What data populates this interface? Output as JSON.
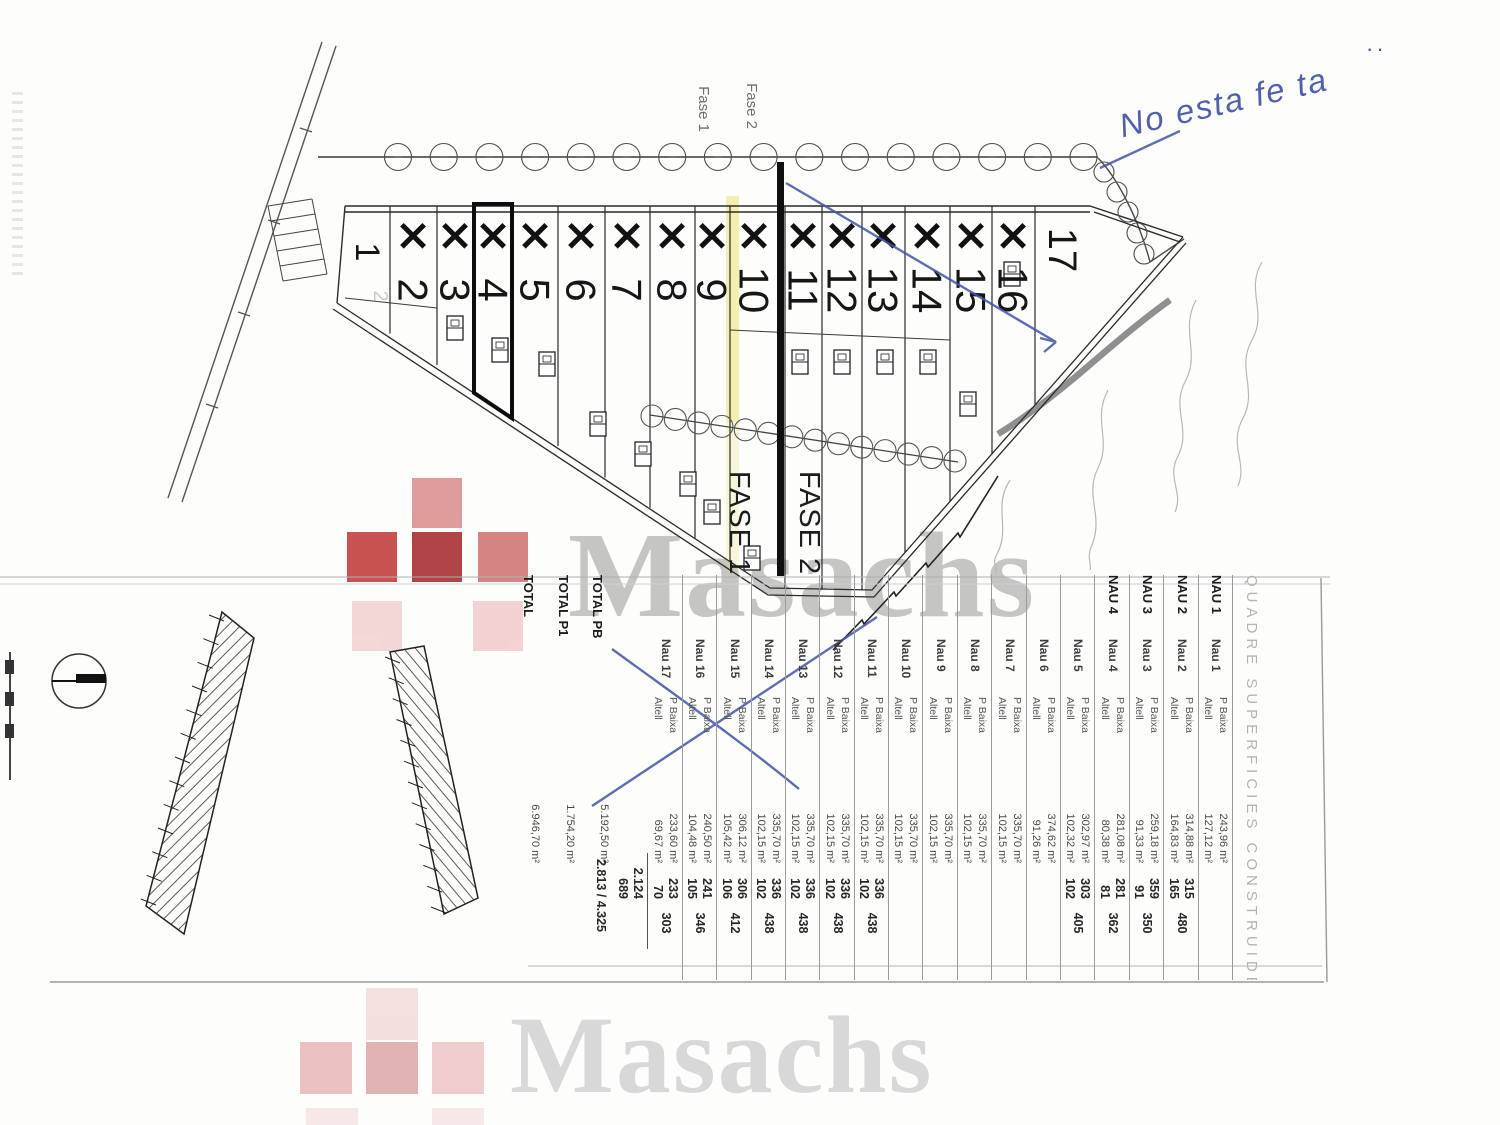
{
  "watermark": {
    "brand": "Masachs"
  },
  "annotation": {
    "note": "No esta fe ta",
    "dots": "··",
    "color": "#3f50a3"
  },
  "plan": {
    "fase1_small": "Fase 1",
    "fase2_small": "Fase 2",
    "fase1_large": "FASE 1",
    "fase2_large": "FASE 2",
    "ghost_label": "2",
    "units": [
      {
        "n": "1",
        "x": false
      },
      {
        "n": "2",
        "x": true
      },
      {
        "n": "3",
        "x": true
      },
      {
        "n": "4",
        "x": true,
        "highlight": true
      },
      {
        "n": "5",
        "x": true
      },
      {
        "n": "6",
        "x": true
      },
      {
        "n": "7",
        "x": true
      },
      {
        "n": "8",
        "x": true
      },
      {
        "n": "9",
        "x": true
      },
      {
        "n": "10",
        "x": true
      },
      {
        "n": "11",
        "x": true
      },
      {
        "n": "12",
        "x": true
      },
      {
        "n": "13",
        "x": true
      },
      {
        "n": "14",
        "x": true
      },
      {
        "n": "15",
        "x": true
      },
      {
        "n": "16",
        "x": true
      },
      {
        "n": "17",
        "x": false
      }
    ]
  },
  "table": {
    "title": "QUADRE SUPERFICIES CONSTRUIDES",
    "floor_top": "P Baixa",
    "floor_bottom": "Altell",
    "rows": [
      {
        "name_bold": "NAU 1",
        "name": "Nau 1",
        "floors": true,
        "pb_area": "243,96 m²",
        "alt_area": "127,12 m²",
        "pb_n": "",
        "alt_n": "",
        "total": ""
      },
      {
        "name_bold": "NAU 2",
        "name": "Nau 2",
        "floors": true,
        "pb_area": "314,88 m²",
        "alt_area": "164,83 m²",
        "pb_n": "315",
        "alt_n": "165",
        "total": "480"
      },
      {
        "name_bold": "NAU 3",
        "name": "Nau 3",
        "floors": true,
        "pb_area": "259,18 m²",
        "alt_area": "91,33 m²",
        "pb_n": "359",
        "alt_n": "91",
        "total": "350"
      },
      {
        "name_bold": "NAU 4",
        "name": "Nau 4",
        "floors": true,
        "pb_area": "281,08 m²",
        "alt_area": "80,38 m²",
        "pb_n": "281",
        "alt_n": "81",
        "total": "362"
      },
      {
        "name": "Nau 5",
        "floors": true,
        "pb_area": "302,97 m²",
        "alt_area": "102,32 m²",
        "pb_n": "303",
        "alt_n": "102",
        "total": "405"
      },
      {
        "name": "Nau 6",
        "floors": true,
        "pb_area": "374,62 m²",
        "alt_area": "91,26 m²",
        "pb_n": "",
        "alt_n": "",
        "total": ""
      },
      {
        "name": "Nau 7",
        "floors": true,
        "pb_area": "335,70 m²",
        "alt_area": "102,15 m²",
        "pb_n": "",
        "alt_n": "",
        "total": ""
      },
      {
        "name": "Nau 8",
        "floors": true,
        "pb_area": "335,70 m²",
        "alt_area": "102,15 m²",
        "pb_n": "",
        "alt_n": "",
        "total": ""
      },
      {
        "name": "Nau 9",
        "floors": true,
        "pb_area": "335,70 m²",
        "alt_area": "102,15 m²",
        "pb_n": "",
        "alt_n": "",
        "total": ""
      },
      {
        "name": "Nau 10",
        "floors": true,
        "pb_area": "335,70 m²",
        "alt_area": "102,15 m²",
        "pb_n": "",
        "alt_n": "",
        "total": ""
      },
      {
        "name": "Nau 11",
        "floors": true,
        "pb_area": "335,70 m²",
        "alt_area": "102,15 m²",
        "pb_n": "336",
        "alt_n": "102",
        "total": "438"
      },
      {
        "name": "Nau 12",
        "floors": true,
        "pb_area": "335,70 m²",
        "alt_area": "102,15 m²",
        "pb_n": "336",
        "alt_n": "102",
        "total": "438"
      },
      {
        "name": "Nau 13",
        "floors": true,
        "pb_area": "335,70 m²",
        "alt_area": "102,15 m²",
        "pb_n": "336",
        "alt_n": "102",
        "total": "438"
      },
      {
        "name": "Nau 14",
        "floors": true,
        "pb_area": "335,70 m²",
        "alt_area": "102,15 m²",
        "pb_n": "336",
        "alt_n": "102",
        "total": "438"
      },
      {
        "name": "Nau 15",
        "floors": true,
        "pb_area": "306,12 m²",
        "alt_area": "105,42 m²",
        "pb_n": "306",
        "alt_n": "106",
        "total": "412"
      },
      {
        "name": "Nau 16",
        "floors": true,
        "pb_area": "240,50 m²",
        "alt_area": "104,48 m²",
        "pb_n": "241",
        "alt_n": "105",
        "total": "346"
      },
      {
        "name": "Nau 17",
        "floors": true,
        "pb_area": "233,60 m²",
        "alt_area": "69,67 m²",
        "pb_n": "233",
        "alt_n": "70",
        "total": "303"
      },
      {
        "subtotal": true,
        "pb_n": "2.124",
        "alt_n": "689"
      },
      {
        "name_bold": "TOTAL PB",
        "pb_area": "5.192,50 m²",
        "total_line": "2.813 / 4.325"
      },
      {
        "name_bold": "TOTAL P1",
        "pb_area": "1.754,20 m²"
      },
      {
        "name_bold": "TOTAL",
        "pb_area": "6.946,70 m²"
      }
    ]
  }
}
